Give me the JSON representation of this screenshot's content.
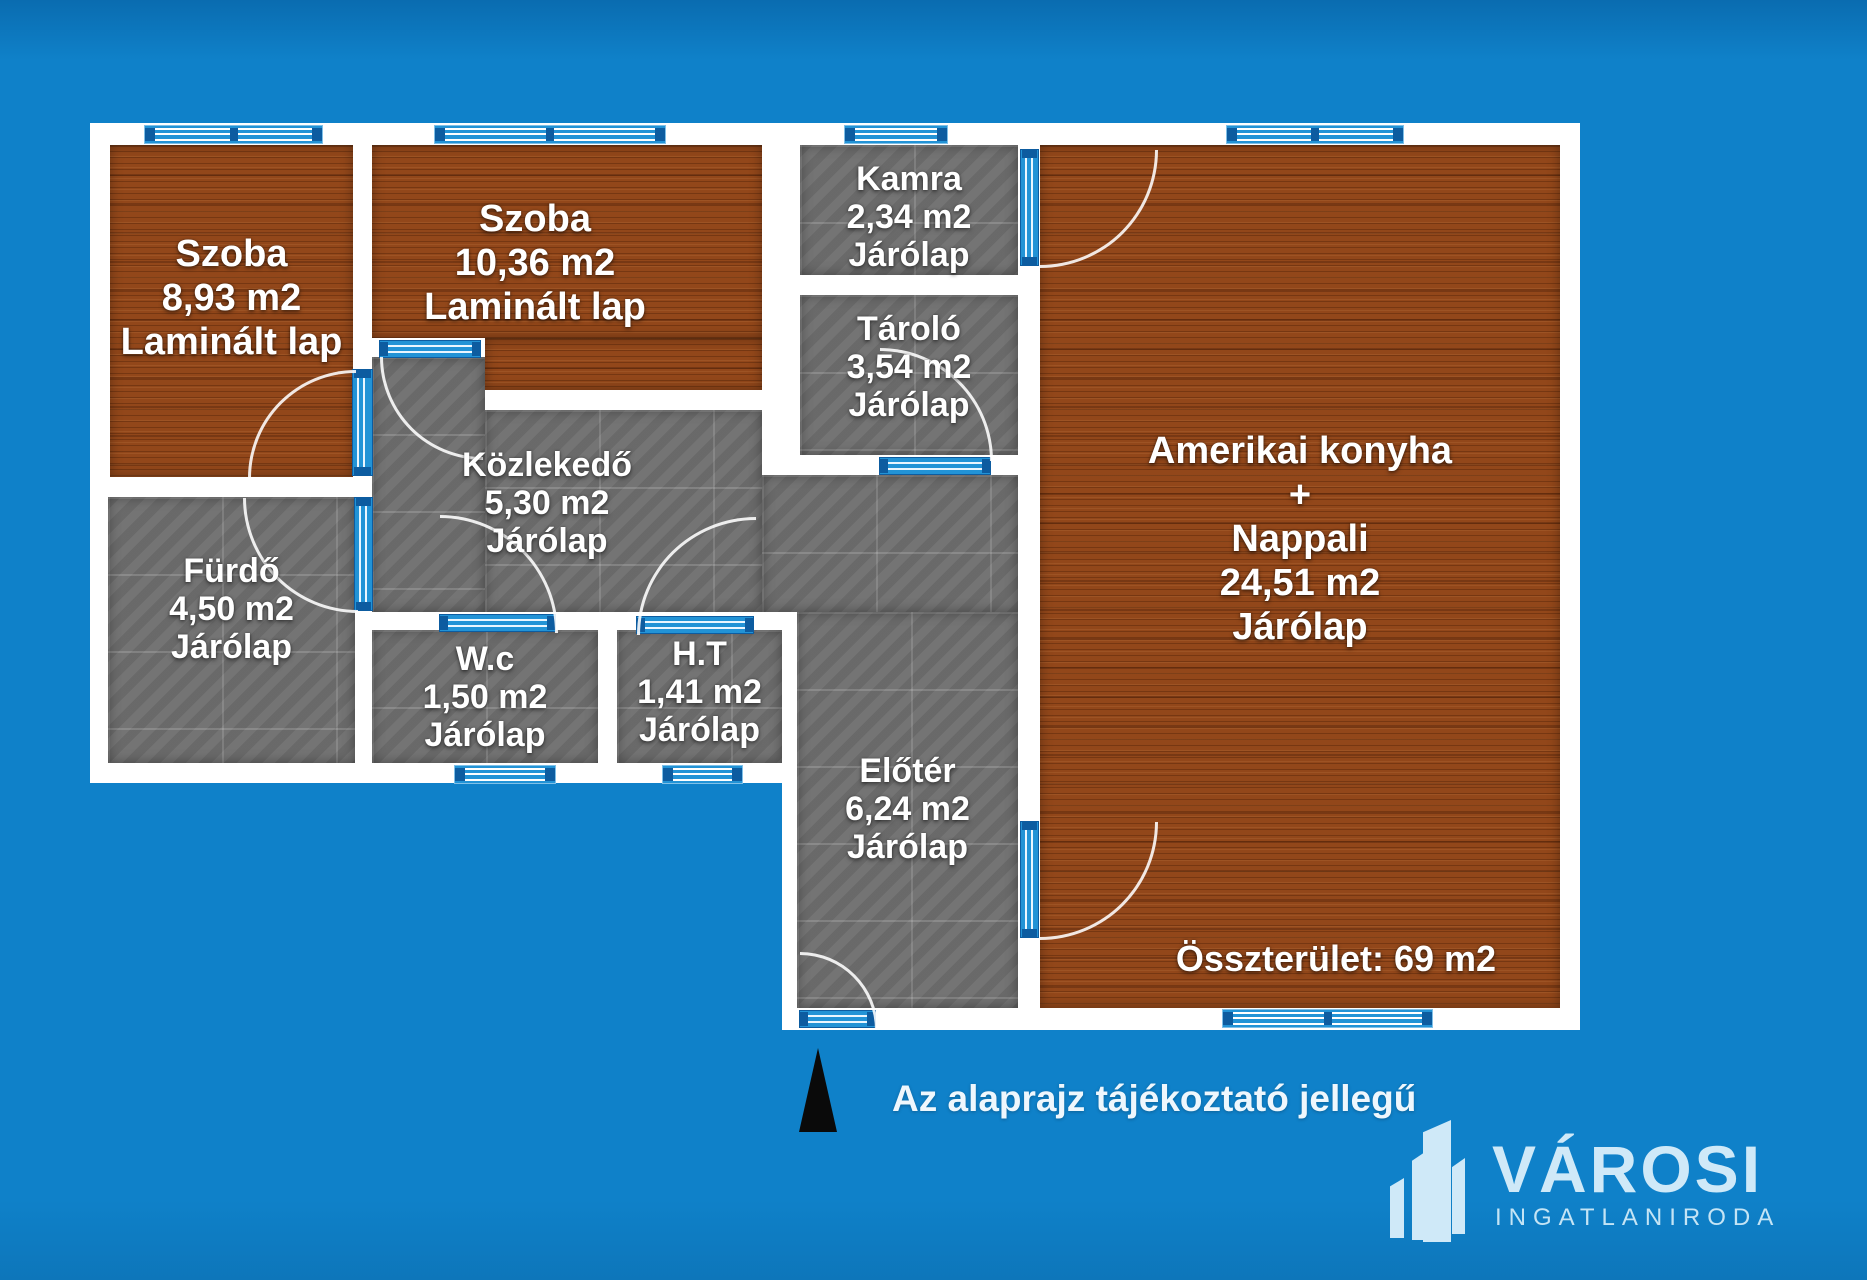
{
  "palette": {
    "background_blue": "#0f81c9",
    "wall_white": "#ffffff",
    "wood_floor_brown": "#92471a",
    "tile_gray": "#6f6f6f",
    "window_door_blue": "#2293d6",
    "window_cap_dark_blue": "#0d5ca0",
    "logo_light_blue": "#cfe9f8",
    "north_arrow_black": "#0a0a0a"
  },
  "icons": {
    "north_arrow": "north-arrow-icon",
    "logo_mark": "buildings-icon"
  },
  "rooms": [
    {
      "name": "Szoba",
      "area": "8,93 m2",
      "floor": "Laminált lap"
    },
    {
      "name": "Szoba",
      "area": "10,36 m2",
      "floor": "Laminált lap"
    },
    {
      "name": "Kamra",
      "area": "2,34 m2",
      "floor": "Járólap"
    },
    {
      "name": "Tároló",
      "area": "3,54 m2",
      "floor": "Járólap"
    },
    {
      "name": "Amerikai konyha",
      "plus": "+",
      "name2": "Nappali",
      "area": "24,51 m2",
      "floor": "Járólap"
    },
    {
      "name": "Közlekedő",
      "area": "5,30 m2",
      "floor": "Járólap"
    },
    {
      "name": "Fürdő",
      "area": "4,50 m2",
      "floor": "Járólap"
    },
    {
      "name": "W.c",
      "area": "1,50 m2",
      "floor": "Járólap"
    },
    {
      "name": "H.T",
      "area": "1,41 m2",
      "floor": "Járólap"
    },
    {
      "name": "Előtér",
      "area": "6,24 m2",
      "floor": "Járólap"
    }
  ],
  "total_label": "Összterület: 69 m2",
  "disclaimer": "Az alaprajz tájékoztató jellegű",
  "logo": {
    "name": "VÁROSI",
    "subtitle": "INGATLANIRODA"
  }
}
